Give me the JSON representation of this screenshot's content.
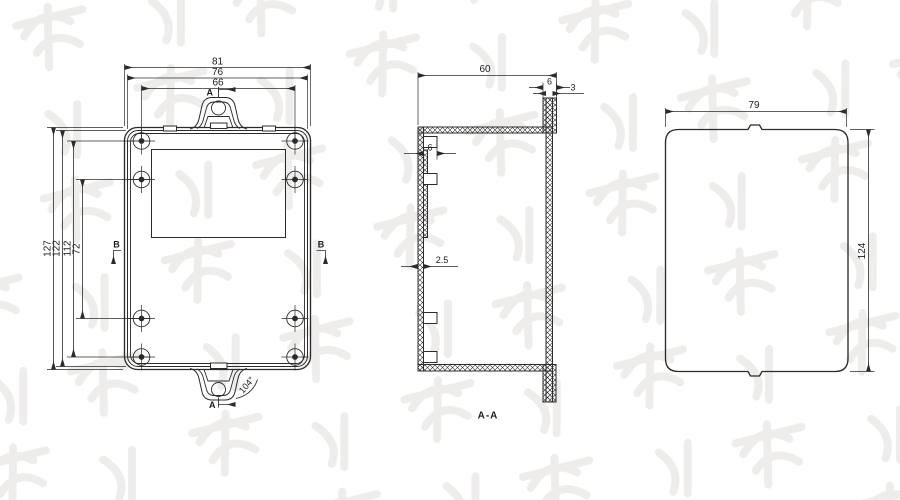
{
  "front": {
    "w_outer": "81",
    "w_mid": "76",
    "w_holes": "66",
    "h_outer": "127",
    "h_mid": "122",
    "h_holes": "112",
    "h_holes_mid": "72",
    "marker_a_top": "A",
    "marker_a_bottom": "A",
    "marker_b_left": "B",
    "marker_b_right": "B",
    "angle": "104°"
  },
  "section": {
    "w": "60",
    "rim": "6",
    "wall": "3",
    "boss": "6",
    "side": "2.5",
    "label": "A-A"
  },
  "side": {
    "w": "79",
    "h": "124"
  },
  "colors": {
    "line": "#2b2b2b",
    "background": "#ffffff",
    "watermark": "#efedeb"
  }
}
